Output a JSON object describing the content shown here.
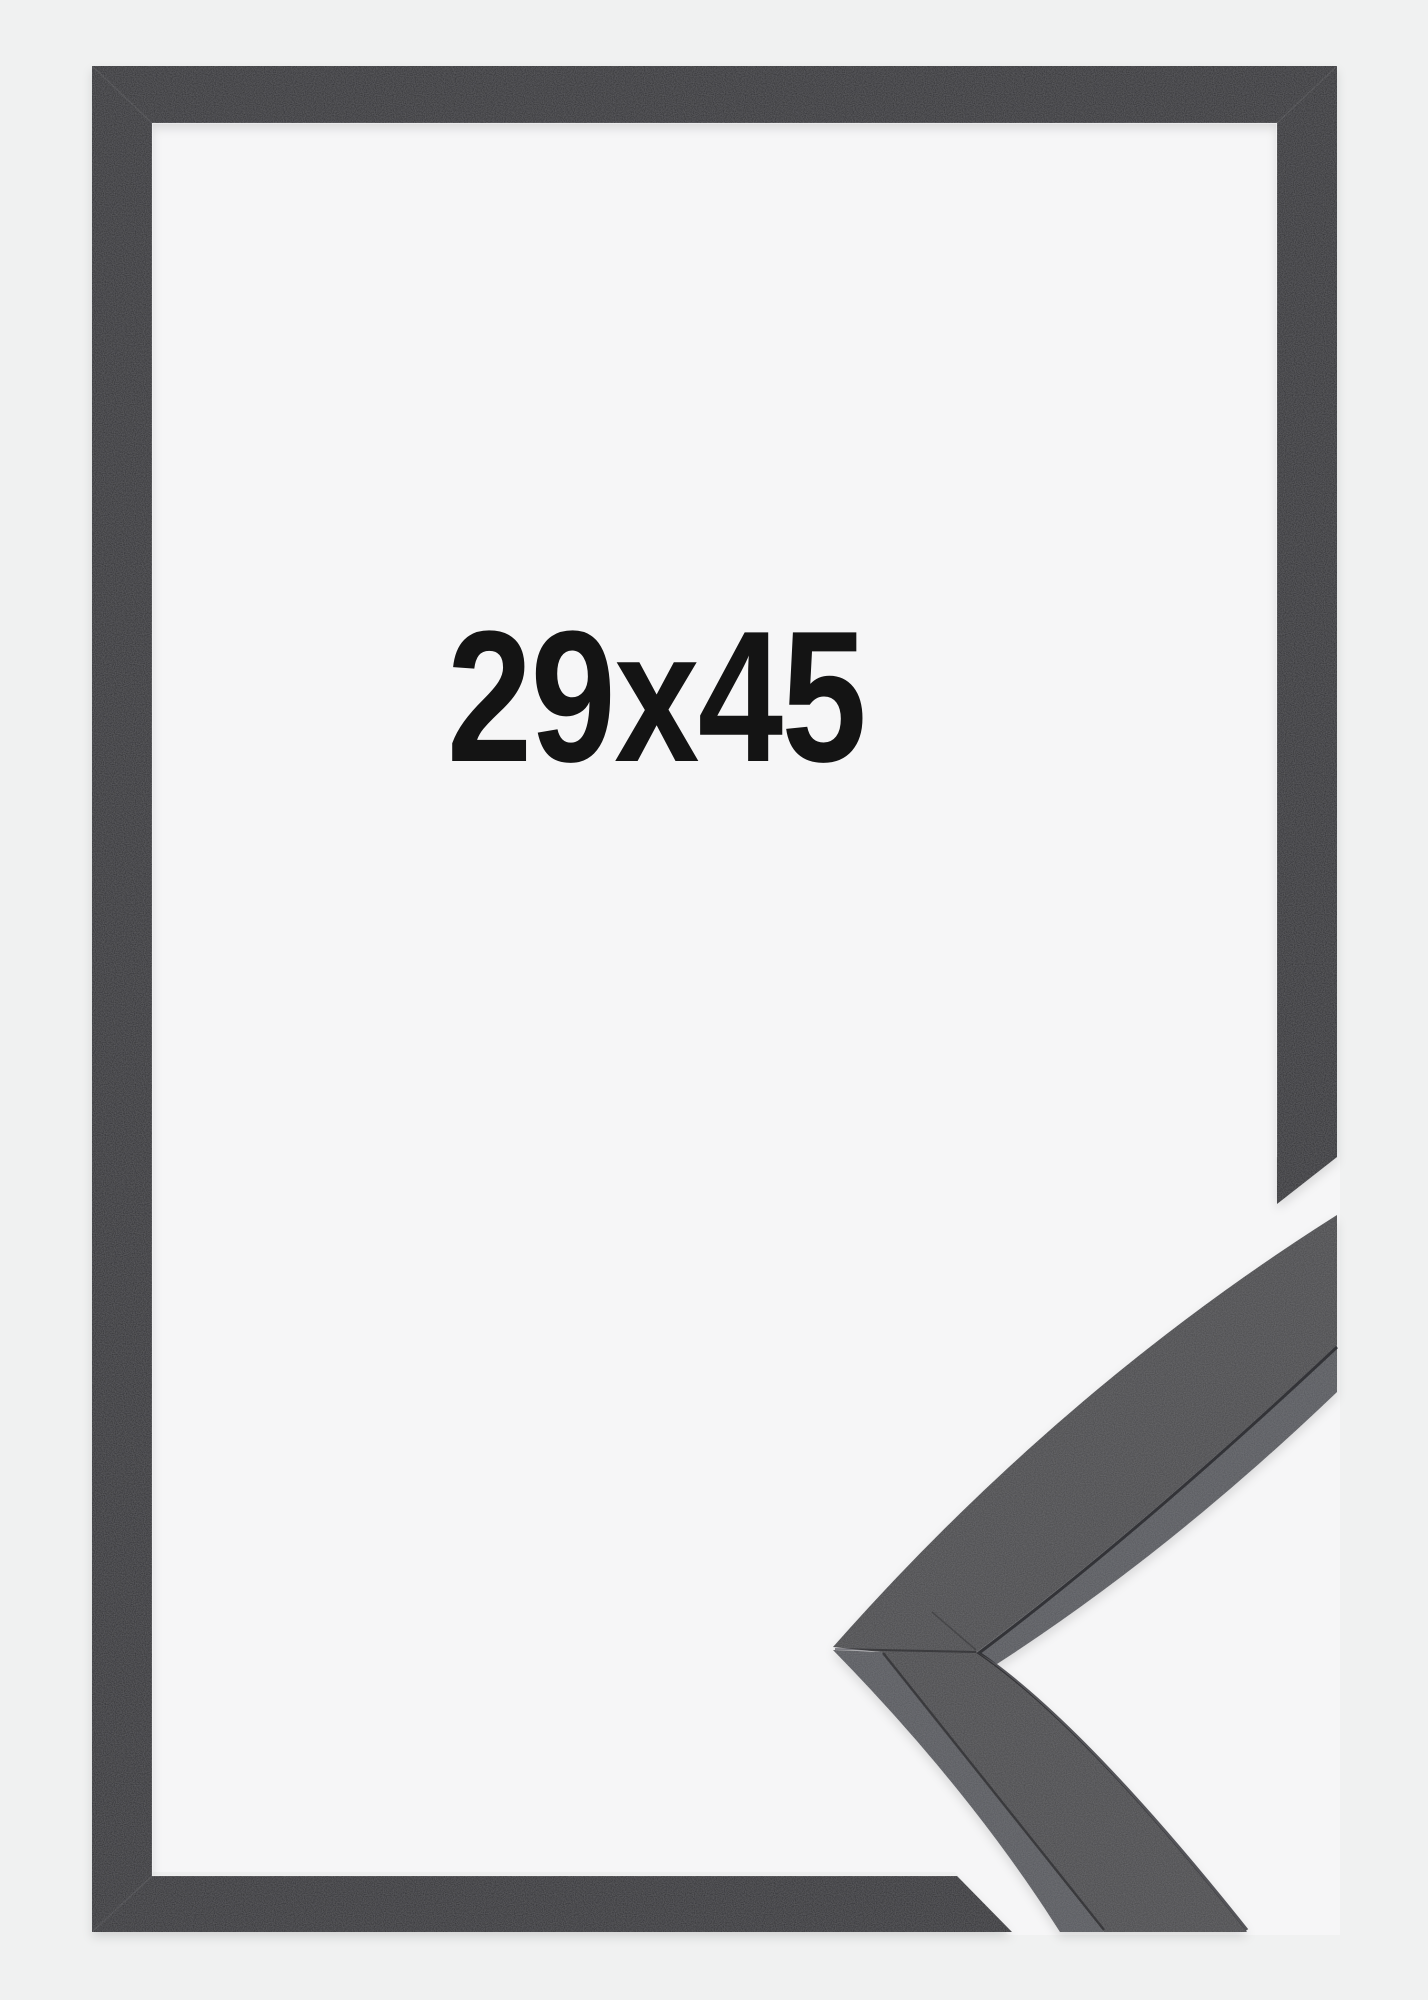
{
  "product": {
    "size_label": "29x45"
  },
  "colors": {
    "page_background": "#f0f1f1",
    "backdrop_inside_frame": "#f6f6f7",
    "frame_moulding": "#2e2f31",
    "sample_face": "#46474a",
    "sample_edge": "#55565b",
    "label_text": "#141414"
  }
}
